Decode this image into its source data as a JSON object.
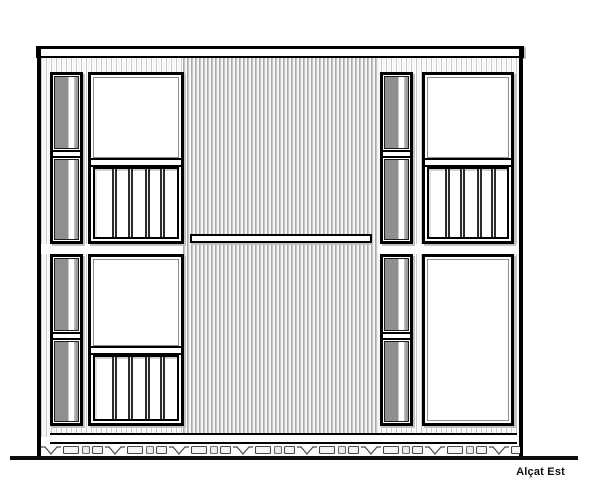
{
  "drawing": {
    "label": "Alçat Est"
  },
  "colors": {
    "line": "#000000",
    "glass": "#8f8f8f",
    "stripe_light": "#c7c7c7",
    "stripe_dark": "#a9a9a9",
    "paper": "#ffffff",
    "shadow": "#c2c2c2"
  }
}
